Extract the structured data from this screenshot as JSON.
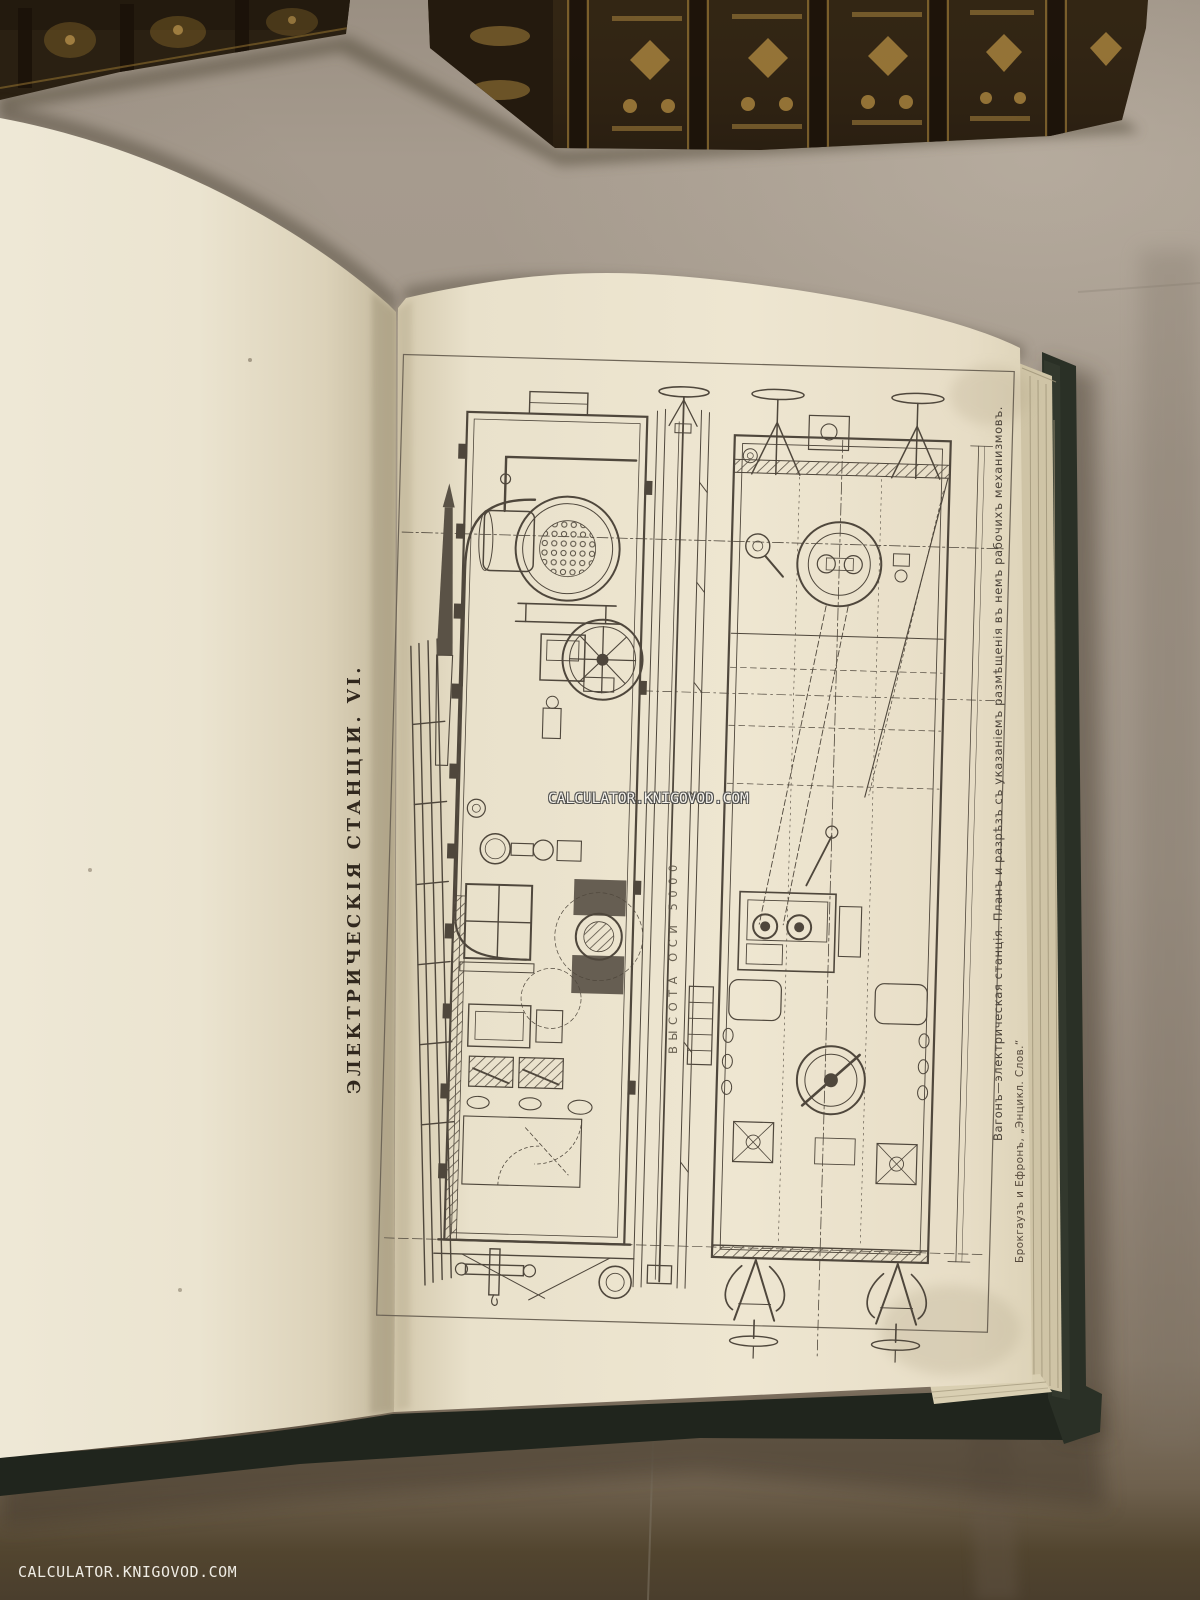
{
  "watermark": {
    "text": "CALCULATOR.KNIGOVOD.COM"
  },
  "plate": {
    "title": "ЭЛЕКТРИЧЕСКІЯ СТАНЦІИ. VI.",
    "dimension_label": "ВЫСОТА ОСИ 5000",
    "caption": "Вагонъ—электрическая станція. Планъ и разрѣзъ съ указаніемъ размѣщенія въ немъ рабочихъ механизмовъ.",
    "credit": "Брокгаузъ и Ефронъ, „Энцикл. Слов.“"
  },
  "colors": {
    "fabric": "#a0958a",
    "page": "#ece4cf",
    "ink": "#4f473c",
    "cover": "#262b22",
    "title_ink": "#31281e"
  }
}
